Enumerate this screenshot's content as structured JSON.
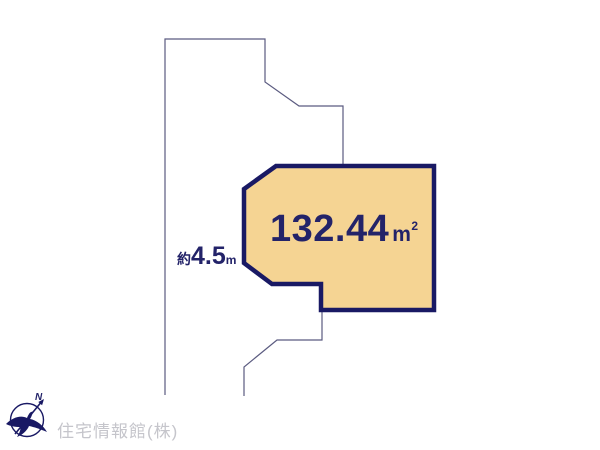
{
  "diagram": {
    "parcel": {
      "area_value": "132.44",
      "area_unit": "m",
      "area_unit_superscript": "2"
    },
    "road": {
      "width_prefix": "約",
      "width_value": "4.5",
      "width_unit": "m"
    },
    "compass": {
      "north_label": "N"
    }
  },
  "footer": {
    "company_name": "住宅情報館(株)"
  },
  "colors": {
    "parcel-fill": "#f5d493",
    "parcel-border": "#191964",
    "label-navy": "#232369",
    "thin-line": "#5b5b80",
    "company-gray": "#c5c5cb",
    "background": "#ffffff"
  }
}
